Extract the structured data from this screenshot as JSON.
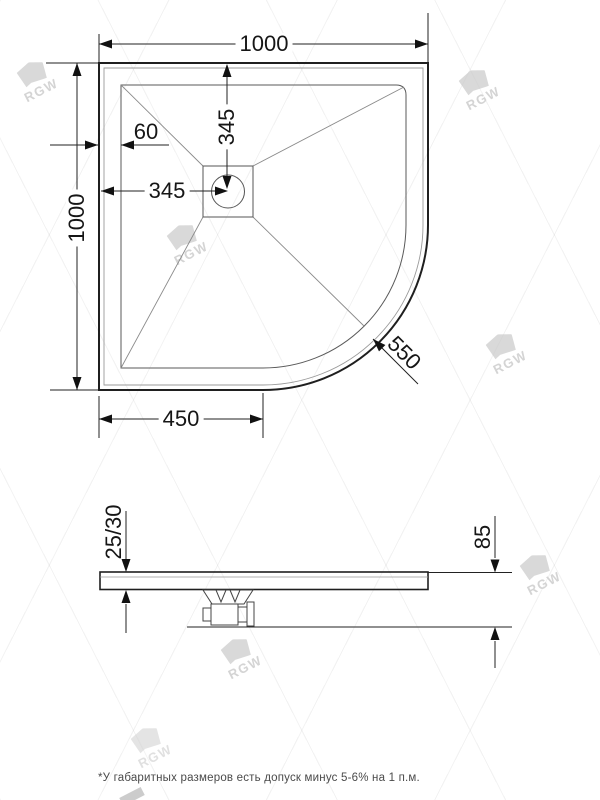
{
  "drawing": {
    "type": "technical-drawing",
    "subject": "quadrant shower tray, plan view and section view",
    "colors": {
      "outline": "#1f1f1f",
      "thin_line": "#8a8a8a",
      "watermark": "#cccccc"
    }
  },
  "top_view": {
    "width_label": "1000",
    "height_label": "1000",
    "rim_width_label": "60",
    "drain_offset_x_label": "345",
    "drain_offset_y_label": "345",
    "straight_edge_label": "450",
    "corner_radius_label": "550"
  },
  "side_view": {
    "tray_thickness_label": "25/30",
    "total_height_label": "85"
  },
  "watermark": {
    "text": "RGW"
  },
  "footer": {
    "note": "*У габаритных размеров есть допуск минус  5-6% на 1 п.м."
  }
}
